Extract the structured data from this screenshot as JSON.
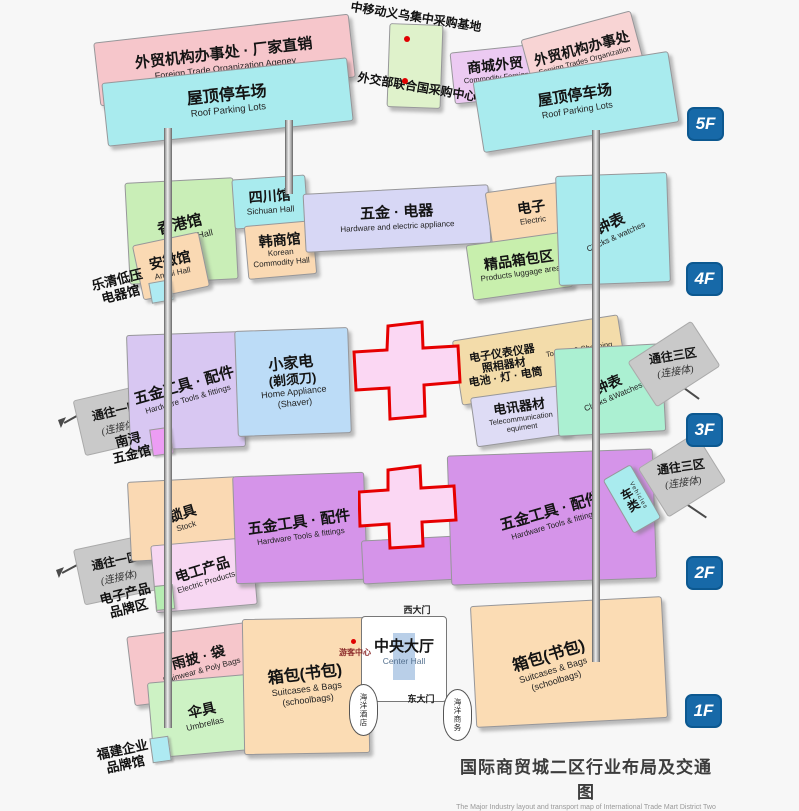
{
  "colors": {
    "badge_blue": "#1769a8",
    "cross_red": "#e60000",
    "cross_fill": "#fbd7f3",
    "dot_red": "#e00000",
    "pink_salmon": "#f6c6cb",
    "pink_light": "#f8d4d4",
    "cyan": "#a9ebee",
    "green_block": "#dff2cb",
    "lavender_pink": "#eccaf2",
    "green_hall": "#c9eeb7",
    "peach": "#fad9b3",
    "periwinkle": "#d7d7f5",
    "lavender_soft": "#dedcf5",
    "green_luggage": "#c8efad",
    "purple_soft": "#d8c7f2",
    "blue_soft": "#bcdcf7",
    "tan": "#f3dcaa",
    "mint": "#abf0d2",
    "gray_conn": "#c9c9c9",
    "purple_mid": "#d594e9",
    "pink_product": "#f7d7f2",
    "peach_bags": "#fbdcb4",
    "green_umbrella": "#cdf2c4",
    "mini_green": "#b6edb2",
    "mini_magenta": "#ec9df4",
    "mini_cyan": "#aeeaf2",
    "hall_blue": "#b9cfe8"
  },
  "icons": {
    "marker_dot": "css-circle",
    "direction_arrow": "css-line-arrow",
    "elevator_shaft": "css-vertical-bar"
  },
  "f5": {
    "badge": "5F",
    "cmcc_label": "中移动义乌集中采购基地",
    "mofa_label": "外交部联合国采购中心",
    "agency_left": {
      "zh": "外贸机构办事处 · 厂家直销",
      "en": "Foreign Trade Organization Ageney"
    },
    "parking_left": {
      "zh": "屋顶停车场",
      "en": "Roof Parking Lots"
    },
    "foreign_trade": {
      "zh": "商城外贸",
      "en": "Commodity Foreign Trades"
    },
    "agency_right": {
      "zh": "外贸机构办事处",
      "en": "Foreign Trades Organization Agency"
    },
    "parking_right": {
      "zh": "屋顶停车场",
      "en": "Roof Parking Lots"
    }
  },
  "f4": {
    "badge": "4F",
    "hongkong": {
      "zh": "香港馆",
      "en": "HongKong Hall"
    },
    "sichuan": {
      "zh": "四川馆",
      "en": "Sichuan Hall"
    },
    "anhui": {
      "zh": "安徽馆",
      "en": "Anhui Hall"
    },
    "korean": {
      "zh": "韩商馆",
      "en1": "Korean",
      "en2": "Commodity Hall"
    },
    "hardware_electric": {
      "zh": "五金 · 电器",
      "en": "Hardware and electric appliance"
    },
    "electric": {
      "zh": "电子",
      "en": "Electric"
    },
    "luggage": {
      "zh": "精品箱包区",
      "en": "Products luggage area"
    },
    "clocks": {
      "zh": "钟表",
      "en": "Clocks & watches"
    },
    "side_label": {
      "line1": "乐清低压",
      "line2": "电器馆"
    }
  },
  "f3": {
    "badge": "3F",
    "conn_left": {
      "zh": "通往一区",
      "sub": "(连接体)"
    },
    "hardware_tools": {
      "zh": "五金工具 · 配件",
      "en": "Hardware Tools & fittings"
    },
    "home_appliance": {
      "zh1": "小家电",
      "zh2": "(剃须刀)",
      "en1": "Home Appliance",
      "en2": "(Shaver)"
    },
    "instruments": {
      "zh1": "电子仪表仪器",
      "zh2": "照相器材",
      "zh3": "电池 · 灯 · 电筒",
      "en1": "Tourism & Shopping",
      "en2": "of Enterprise"
    },
    "telecom": {
      "zh": "电讯器材",
      "en1": "Telecommunication",
      "en2": "equiment"
    },
    "clocks": {
      "zh": "钟表",
      "en": "Clocks &Watches"
    },
    "conn_right": {
      "zh": "通往三区",
      "sub": "(连接体)"
    },
    "side_label": {
      "line1": "南浔",
      "line2": "五金馆"
    }
  },
  "f2": {
    "badge": "2F",
    "conn_left": {
      "zh": "通往一区",
      "sub": "(连接体)"
    },
    "lock": {
      "zh": "锁具",
      "en": "Stock"
    },
    "electric_products": {
      "zh": "电工产品",
      "en": "Electric Products"
    },
    "hardware_tools_left": {
      "zh": "五金工具 · 配件",
      "en": "Hardware Tools & fittings"
    },
    "hardware_tools_right": {
      "zh": "五金工具 · 配件",
      "en": "Hardware Tools & fittings"
    },
    "vehicles": {
      "zh": "车类",
      "en": "Vehicles"
    },
    "conn_right": {
      "zh": "通往三区",
      "sub": "(连接体)"
    },
    "side_label": {
      "line1": "电子产品",
      "line2": "品牌区"
    }
  },
  "f1": {
    "badge": "1F",
    "rainwear": {
      "zh": "雨披 · 袋",
      "en": "Rainwear & Poly Bags"
    },
    "umbrellas": {
      "zh": "伞具",
      "en": "Umbrellas"
    },
    "bags_left": {
      "zh": "箱包(书包)",
      "en1": "Suitcases & Bags",
      "en2": "(schoolbags)"
    },
    "bags_right": {
      "zh": "箱包(书包)",
      "en1": "Suitcases & Bags",
      "en2": "(schoolbags)"
    },
    "visitor_center": "游客中心",
    "west_gate": "西大门",
    "east_gate": "东大门",
    "center_hall": {
      "zh": "中央大厅",
      "en": "Center Hall"
    },
    "hotel": "海洋酒店",
    "business": "海洋商务",
    "side_label": {
      "line1": "福建企业",
      "line2": "品牌馆"
    }
  },
  "footer": {
    "zh": "国际商贸城二区行业布局及交通图",
    "en": "The Major Industry layout and transport map of International Trade Mart District Two"
  }
}
